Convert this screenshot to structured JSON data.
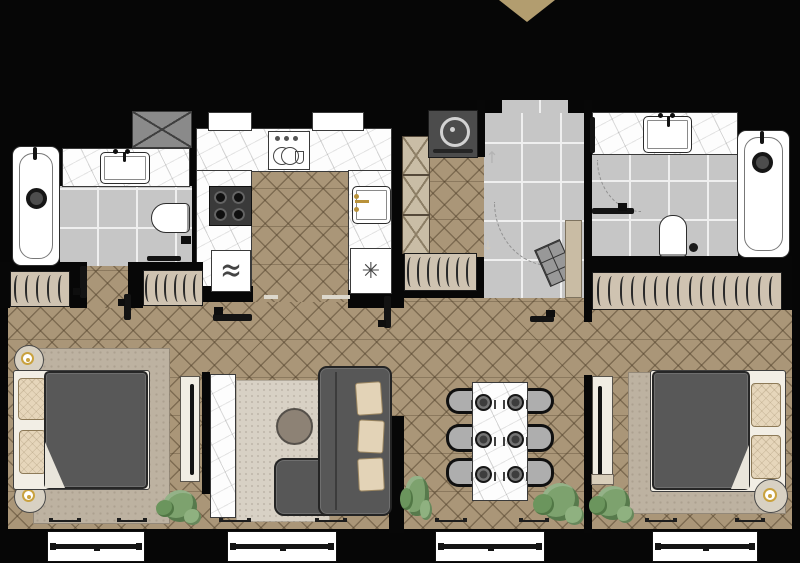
{
  "meta": {
    "title": "Two-bedroom apartment floor plan",
    "view": "top-down architectural plan",
    "style": "black walls, herringbone wood flooring, gray tile wet zones, marble counters"
  },
  "palette": {
    "wall": "#070707",
    "wood_floor": "#aa9678",
    "wood_line": "#52422c",
    "tile_floor": "#c6c6c6",
    "marble": "#fdfdfd",
    "wardrobe_fill": "#cfc3b1",
    "furniture_dark_gray": "#585858",
    "pillow_beige": "#e6d6bb",
    "rug_bedroom": "#bdb2a1",
    "rug_living": "#d8d1c5",
    "chair_gray": "#aeaeae",
    "plant_green": "#7da26e",
    "accent_gold": "#c9a23f",
    "entry_marker_tan": "#b29d6f",
    "appliance_dark": "#4c4c4c"
  },
  "icons": {
    "microwave_waves": "≈",
    "ceiling_light": "✳",
    "arrow_up": "↑",
    "arrow_down": "↓"
  },
  "rooms": {
    "bathroom_1": {
      "label": "Bathroom 1",
      "items": [
        "bathtub",
        "shower-head",
        "marble vanity with sink",
        "wall-hung toilet",
        "toilet-paper holder",
        "towel rail",
        "utility shaft box"
      ]
    },
    "kitchen": {
      "label": "Kitchen",
      "items": [
        "upper cabinets (dashed X)",
        "dish rack",
        "4-burner cooktop",
        "microwave",
        "sink with gold faucet",
        "cabinet with ceiling light",
        "tall cabinet column"
      ]
    },
    "entry_hall": {
      "label": "Entry Hall",
      "items": [
        "entrance marker triangle",
        "washing machine",
        "quilted shoe bench",
        "closet panel",
        "direction arrows"
      ]
    },
    "bathroom_2": {
      "label": "Bathroom 2",
      "items": [
        "marble vanity with sink",
        "bathtub",
        "shower-head",
        "toilet",
        "toilet brush",
        "towel rail",
        "open door with swing arc"
      ]
    },
    "corridor": {
      "label": "Corridor",
      "items": [
        "wardrobe with hangers x4",
        "open door leaves x5",
        "floor thresholds"
      ]
    },
    "bedroom_1": {
      "label": "Bedroom 1",
      "items": [
        "double bed",
        "pillows x2",
        "dark gray duvet",
        "round nightstand x2",
        "gold table lamp x2",
        "rug",
        "TV panel with TV",
        "plant",
        "windows x2"
      ]
    },
    "living_room": {
      "label": "Living Room",
      "items": [
        "corner sofa with chaise",
        "beige cushions x3",
        "round coffee table",
        "speckled rug",
        "marble TV wall",
        "plant",
        "window"
      ]
    },
    "dining_area": {
      "label": "Dining Area",
      "items": [
        "marble dining table",
        "place settings x6",
        "upholstered chairs x6",
        "plant",
        "window"
      ]
    },
    "bedroom_2": {
      "label": "Bedroom 2",
      "items": [
        "double bed",
        "pillows x2",
        "dark gray duvet",
        "round nightstand",
        "gold table lamp",
        "rug",
        "TV panel with TV",
        "plants x2",
        "window"
      ]
    }
  }
}
